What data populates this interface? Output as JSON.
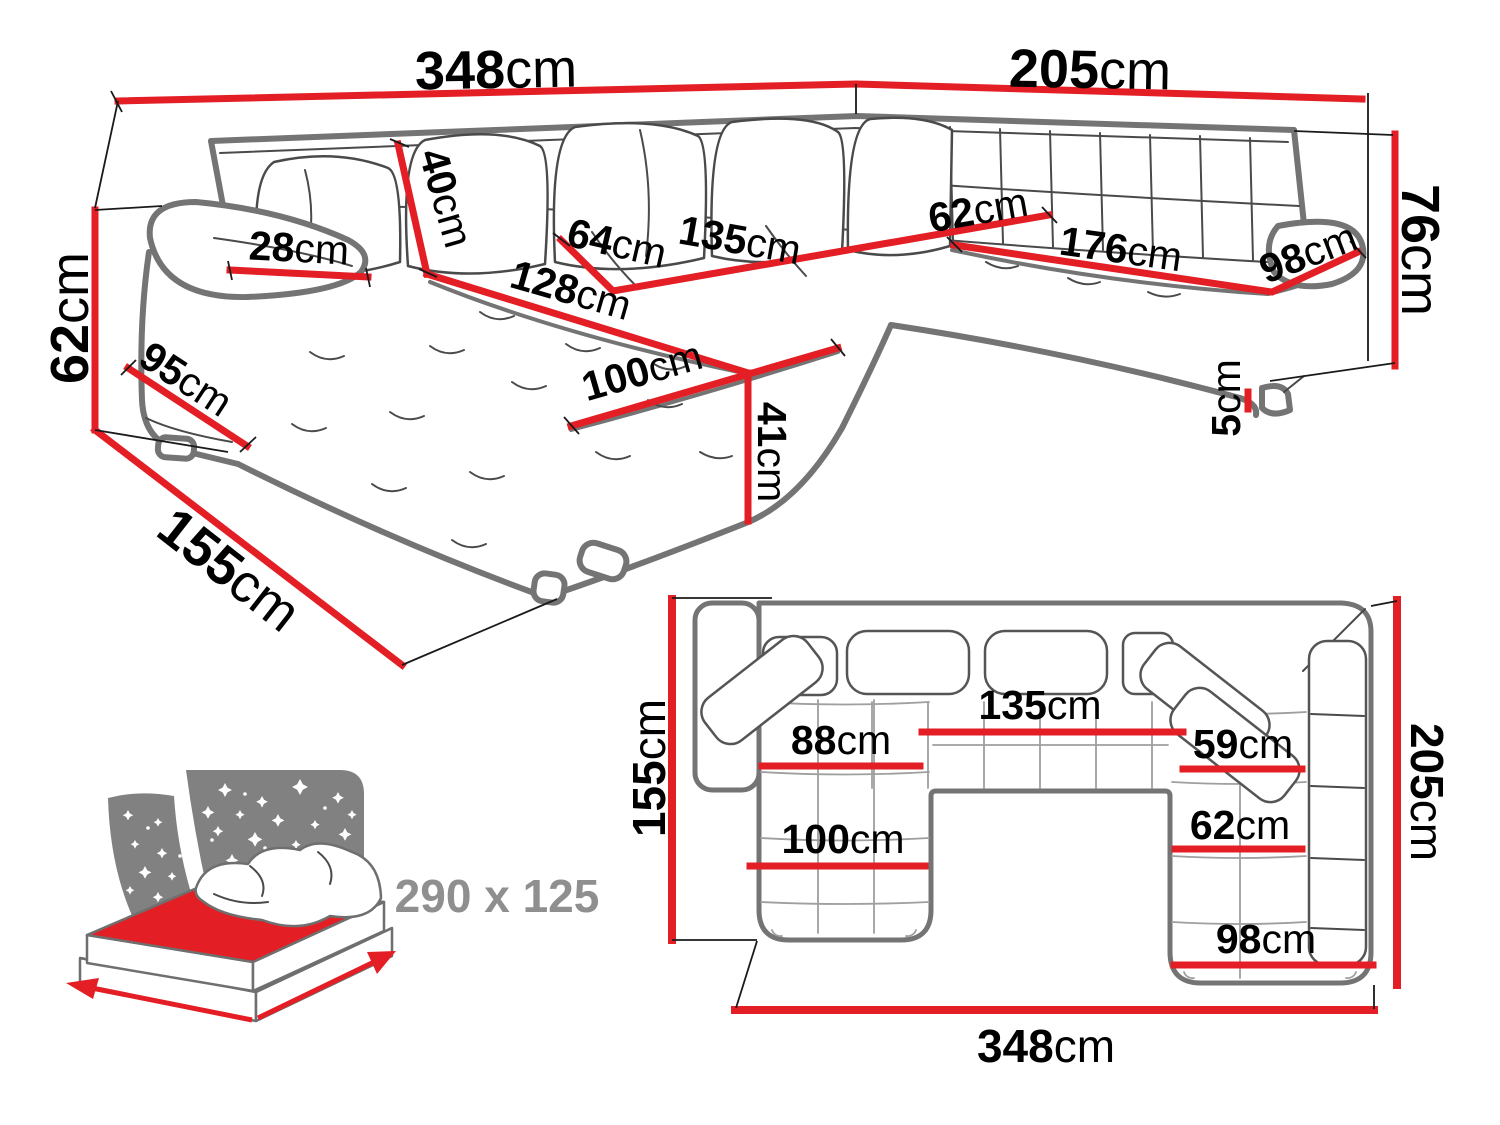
{
  "colors": {
    "dimension_red": "#e31e24",
    "sofa_outline_gray": "#747474",
    "detail_line_gray": "#4a4a4a",
    "icon_gray": "#818181",
    "bed_size_text_gray": "#8f8f8f",
    "label_black": "#000000",
    "background": "#ffffff"
  },
  "perspective_view": {
    "description": "U-shaped corner sofa, perspective line drawing with dimensions",
    "dimensions": {
      "top_width": {
        "value": "348",
        "unit": "cm"
      },
      "top_right_depth": {
        "value": "205",
        "unit": "cm"
      },
      "left_side_height": {
        "value": "62",
        "unit": "cm"
      },
      "chaise_depth": {
        "value": "155",
        "unit": "cm"
      },
      "armrest_width": {
        "value": "28",
        "unit": "cm"
      },
      "back_cushion_height": {
        "value": "40",
        "unit": "cm"
      },
      "middle_seat_depth": {
        "value": "64",
        "unit": "cm"
      },
      "middle_seat_width": {
        "value": "135",
        "unit": "cm"
      },
      "chaise_length": {
        "value": "128",
        "unit": "cm"
      },
      "chaise_seat_width": {
        "value": "100",
        "unit": "cm"
      },
      "armrest_side_depth": {
        "value": "95",
        "unit": "cm"
      },
      "seat_height": {
        "value": "41",
        "unit": "cm"
      },
      "right_seat_depth": {
        "value": "62",
        "unit": "cm"
      },
      "right_seat_length": {
        "value": "176",
        "unit": "cm"
      },
      "right_section_depth": {
        "value": "98",
        "unit": "cm"
      },
      "backrest_height": {
        "value": "76",
        "unit": "cm"
      },
      "leg_height": {
        "value": "5",
        "unit": "cm"
      }
    }
  },
  "plan_view": {
    "description": "U-shaped corner sofa, top (plan) view with dimensions",
    "dimensions": {
      "left_depth": {
        "value": "155",
        "unit": "cm"
      },
      "right_depth": {
        "value": "205",
        "unit": "cm"
      },
      "bottom_width": {
        "value": "348",
        "unit": "cm"
      },
      "chaise_upper_width": {
        "value": "88",
        "unit": "cm"
      },
      "middle_seat_width": {
        "value": "135",
        "unit": "cm"
      },
      "right_seat_upper_width": {
        "value": "59",
        "unit": "cm"
      },
      "right_seat_width": {
        "value": "62",
        "unit": "cm"
      },
      "chaise_width": {
        "value": "100",
        "unit": "cm"
      },
      "right_section_width": {
        "value": "98",
        "unit": "cm"
      }
    }
  },
  "sleeping_function": {
    "bed_size_label": "290 x 125"
  }
}
